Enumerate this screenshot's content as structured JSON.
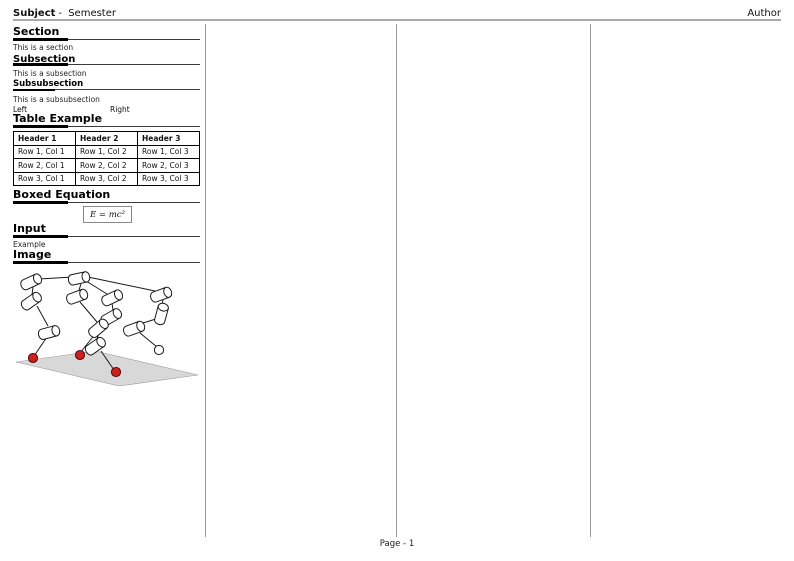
{
  "header": {
    "subject": "Subject",
    "separator": "-",
    "semester": "Semester",
    "author": "Author"
  },
  "column1": {
    "section": {
      "title": "Section",
      "body": "This is a section"
    },
    "subsection": {
      "title": "Subsection",
      "body": "This is a subsection"
    },
    "subsubsection": {
      "title": "Subsubsection",
      "body": "This is a subsubsection"
    },
    "two_col": {
      "left": "Left",
      "right": "Right"
    },
    "table": {
      "title": "Table Example",
      "headers": [
        "Header 1",
        "Header 2",
        "Header 3"
      ],
      "rows": [
        [
          "Row 1, Col 1",
          "Row 1, Col 2",
          "Row 1, Col 3"
        ],
        [
          "Row 2, Col 1",
          "Row 2, Col 2",
          "Row 2, Col 3"
        ],
        [
          "Row 3, Col 1",
          "Row 3, Col 2",
          "Row 3, Col 3"
        ]
      ]
    },
    "boxed_equation": {
      "title": "Boxed Equation",
      "formula": "E = mc²"
    },
    "input": {
      "title": "Input",
      "body": "Example"
    },
    "image": {
      "title": "Image",
      "figure": "robot-linkage-figure"
    }
  },
  "footer": {
    "page_label": "Page - 1"
  },
  "colors": {
    "header_rule": "#aaaaaa",
    "column_separator": "#999999",
    "foot_red": "#cc1f1f",
    "ground_gray": "#d8d8d8"
  }
}
